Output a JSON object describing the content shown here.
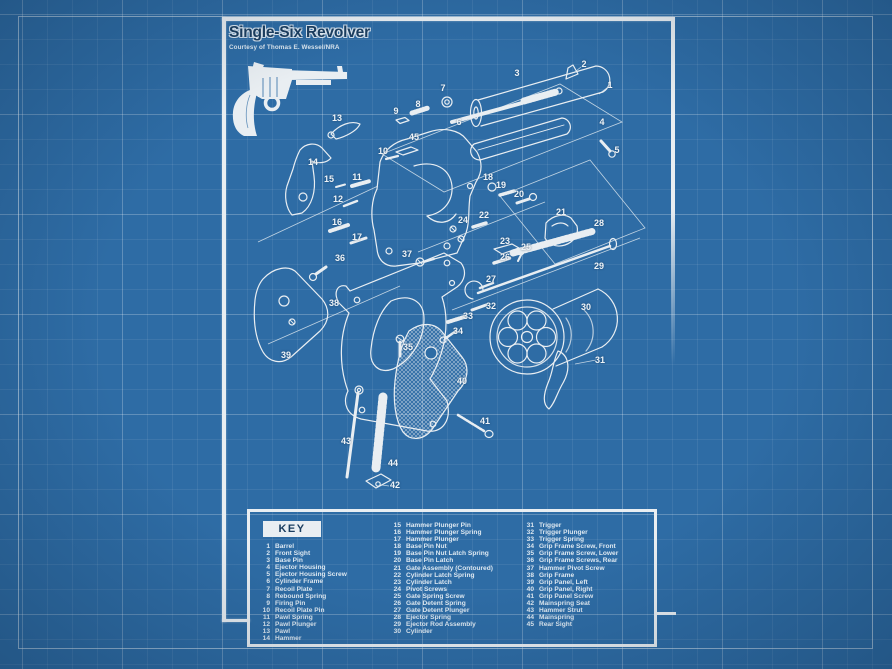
{
  "title_block": {
    "title": "Single-Six Revolver",
    "courtesy": "Courtesy of Thomas E. Wessel/NRA"
  },
  "key": {
    "header": "KEY",
    "columns": [
      {
        "items": [
          {
            "num": "1",
            "name": "Barrel"
          },
          {
            "num": "2",
            "name": "Front Sight"
          },
          {
            "num": "3",
            "name": "Base Pin"
          },
          {
            "num": "4",
            "name": "Ejector Housing"
          },
          {
            "num": "5",
            "name": "Ejector Housing Screw"
          },
          {
            "num": "6",
            "name": "Cylinder Frame"
          },
          {
            "num": "7",
            "name": "Recoil Plate"
          },
          {
            "num": "8",
            "name": "Rebound Spring"
          },
          {
            "num": "9",
            "name": "Firing Pin"
          },
          {
            "num": "10",
            "name": "Recoil Plate Pin"
          },
          {
            "num": "11",
            "name": "Pawl Spring"
          },
          {
            "num": "12",
            "name": "Pawl Plunger"
          },
          {
            "num": "13",
            "name": "Pawl"
          },
          {
            "num": "14",
            "name": "Hammer"
          }
        ]
      },
      {
        "items": [
          {
            "num": "15",
            "name": "Hammer Plunger Pin"
          },
          {
            "num": "16",
            "name": "Hammer Plunger Spring"
          },
          {
            "num": "17",
            "name": "Hammer Plunger"
          },
          {
            "num": "18",
            "name": "Base Pin Nut"
          },
          {
            "num": "19",
            "name": "Base Pin Nut Latch Spring"
          },
          {
            "num": "20",
            "name": "Base Pin Latch"
          },
          {
            "num": "21",
            "name": "Gate Assembly (Contoured)"
          },
          {
            "num": "22",
            "name": "Cylinder Latch Spring"
          },
          {
            "num": "23",
            "name": "Cylinder Latch"
          },
          {
            "num": "24",
            "name": "Pivot Screws"
          },
          {
            "num": "25",
            "name": "Gate Spring Screw"
          },
          {
            "num": "26",
            "name": "Gate Detent Spring"
          },
          {
            "num": "27",
            "name": "Gate Detent Plunger"
          },
          {
            "num": "28",
            "name": "Ejector Spring"
          },
          {
            "num": "29",
            "name": "Ejector Rod Assembly"
          },
          {
            "num": "30",
            "name": "Cylinder"
          }
        ]
      },
      {
        "items": [
          {
            "num": "31",
            "name": "Trigger"
          },
          {
            "num": "32",
            "name": "Trigger Plunger"
          },
          {
            "num": "33",
            "name": "Trigger Spring"
          },
          {
            "num": "34",
            "name": "Grip Frame Screw, Front"
          },
          {
            "num": "35",
            "name": "Grip Frame Screw, Lower"
          },
          {
            "num": "36",
            "name": "Grip Frame Screws, Rear"
          },
          {
            "num": "37",
            "name": "Hammer Pivot Screw"
          },
          {
            "num": "38",
            "name": "Grip Frame"
          },
          {
            "num": "39",
            "name": "Grip Panel, Left"
          },
          {
            "num": "40",
            "name": "Grip Panel, Right"
          },
          {
            "num": "41",
            "name": "Grip Panel Screw"
          },
          {
            "num": "42",
            "name": "Mainspring Seat"
          },
          {
            "num": "43",
            "name": "Hammer Strut"
          },
          {
            "num": "44",
            "name": "Mainspring"
          },
          {
            "num": "45",
            "name": "Rear Sight"
          }
        ]
      }
    ]
  },
  "diagram": {
    "callouts": [
      {
        "n": "1",
        "x": 610,
        "y": 85
      },
      {
        "n": "2",
        "x": 584,
        "y": 64
      },
      {
        "n": "3",
        "x": 517,
        "y": 73
      },
      {
        "n": "4",
        "x": 602,
        "y": 122
      },
      {
        "n": "5",
        "x": 617,
        "y": 150
      },
      {
        "n": "6",
        "x": 459,
        "y": 122
      },
      {
        "n": "7",
        "x": 443,
        "y": 88
      },
      {
        "n": "8",
        "x": 418,
        "y": 104
      },
      {
        "n": "9",
        "x": 396,
        "y": 111
      },
      {
        "n": "10",
        "x": 383,
        "y": 151
      },
      {
        "n": "11",
        "x": 357,
        "y": 177
      },
      {
        "n": "12",
        "x": 338,
        "y": 199
      },
      {
        "n": "13",
        "x": 337,
        "y": 118
      },
      {
        "n": "14",
        "x": 313,
        "y": 162
      },
      {
        "n": "15",
        "x": 329,
        "y": 179
      },
      {
        "n": "16",
        "x": 337,
        "y": 222
      },
      {
        "n": "17",
        "x": 357,
        "y": 237
      },
      {
        "n": "18",
        "x": 488,
        "y": 177
      },
      {
        "n": "19",
        "x": 501,
        "y": 185
      },
      {
        "n": "20",
        "x": 519,
        "y": 194
      },
      {
        "n": "21",
        "x": 561,
        "y": 212
      },
      {
        "n": "22",
        "x": 484,
        "y": 215
      },
      {
        "n": "23",
        "x": 505,
        "y": 241
      },
      {
        "n": "24",
        "x": 463,
        "y": 220
      },
      {
        "n": "25",
        "x": 526,
        "y": 247
      },
      {
        "n": "26",
        "x": 505,
        "y": 257
      },
      {
        "n": "27",
        "x": 491,
        "y": 279
      },
      {
        "n": "28",
        "x": 599,
        "y": 223
      },
      {
        "n": "29",
        "x": 599,
        "y": 266
      },
      {
        "n": "30",
        "x": 586,
        "y": 307
      },
      {
        "n": "31",
        "x": 600,
        "y": 360
      },
      {
        "n": "32",
        "x": 491,
        "y": 306
      },
      {
        "n": "33",
        "x": 468,
        "y": 316
      },
      {
        "n": "34",
        "x": 458,
        "y": 331
      },
      {
        "n": "35",
        "x": 408,
        "y": 347
      },
      {
        "n": "36",
        "x": 340,
        "y": 258
      },
      {
        "n": "37",
        "x": 407,
        "y": 254
      },
      {
        "n": "38",
        "x": 334,
        "y": 303
      },
      {
        "n": "39",
        "x": 286,
        "y": 355
      },
      {
        "n": "40",
        "x": 462,
        "y": 381
      },
      {
        "n": "41",
        "x": 485,
        "y": 421
      },
      {
        "n": "42",
        "x": 395,
        "y": 485
      },
      {
        "n": "43",
        "x": 346,
        "y": 441
      },
      {
        "n": "44",
        "x": 393,
        "y": 463
      },
      {
        "n": "45",
        "x": 414,
        "y": 137
      }
    ]
  },
  "colors": {
    "background": "#2e6ca5",
    "line": "#e9eef2",
    "title_text": "#1b3e60"
  }
}
